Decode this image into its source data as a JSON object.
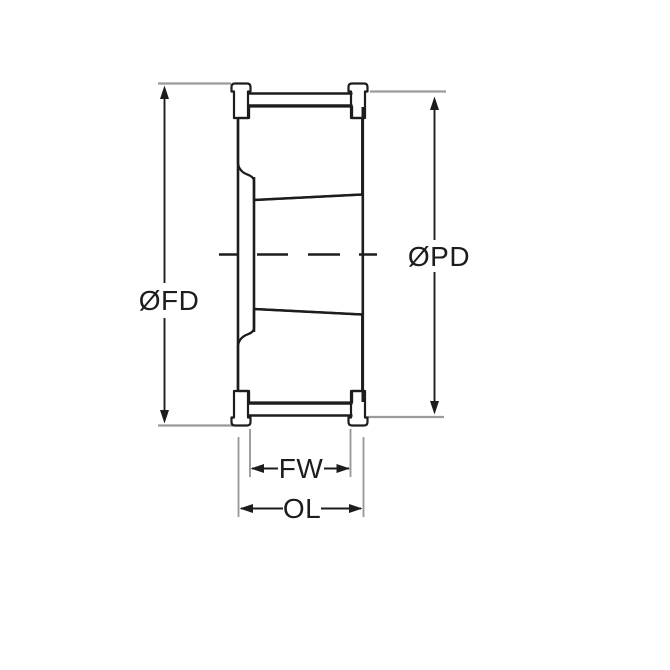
{
  "drawing": {
    "type": "technical-cross-section",
    "subject": "taper-bore timing pulley side profile with flanges, hatched section cuts, conical bore and centerline",
    "labels": {
      "flange_diameter": "ØFD",
      "pitch_diameter": "ØPD",
      "face_width": "FW",
      "overall_length": "OL"
    },
    "colors": {
      "line": "#1d1d1d",
      "extension": "#9a9a9a",
      "background": "#ffffff"
    }
  }
}
